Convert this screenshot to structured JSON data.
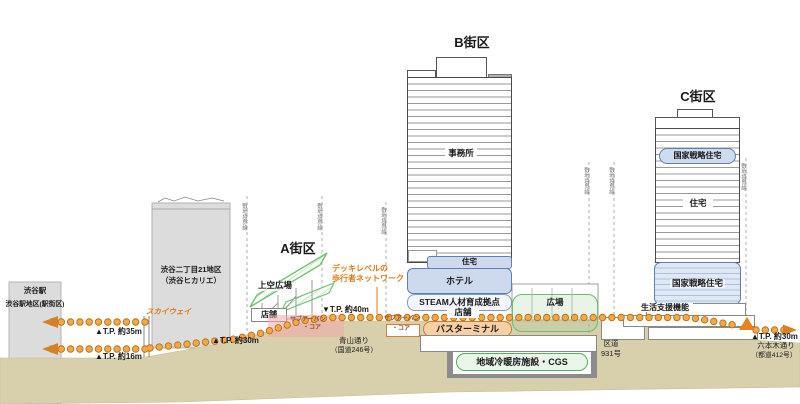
{
  "districts": {
    "a": {
      "label": "A街区",
      "sky_plaza": "上空広場",
      "shop": "店舗",
      "suburban_core_line1": "サブアーバン",
      "suburban_core_line2": "・コア"
    },
    "b": {
      "label": "B街区",
      "office": "事務所",
      "residence": "住宅",
      "hotel": "ホテル",
      "steam": "STEAM人材育成拠点",
      "shop": "店舗",
      "suburban_core_line1": "サブアーバン",
      "suburban_core_line2": "・コア",
      "bus_terminal": "バスターミナル",
      "plaza": "広場",
      "dhc": "地域冷暖房施設・CGS"
    },
    "c": {
      "label": "C街区",
      "nsh_upper": "国家戦略住宅",
      "residence": "住宅",
      "nsh_lower": "国家戦略住宅",
      "life_support": "生活支援機能"
    }
  },
  "left_area": {
    "station": "渋谷駅",
    "station_district": "渋谷駅地区(駅街区)",
    "hikarie_line1": "渋谷二丁目21地区",
    "hikarie_line2": "（渋谷ヒカリエ）",
    "skyway": "スカイウェイ"
  },
  "levels": {
    "tp35": "▲T.P. 約35m",
    "tp16": "▲T.P. 約16m",
    "tp30_a": "▲T.P. 約30m",
    "tp40_b": "▼T.P. 約40m",
    "tp30_c": "▲T.P. 約30m"
  },
  "deck_network": {
    "line1": "デッキレベルの",
    "line2": "歩行者ネットワーク"
  },
  "roads": {
    "aoyama_line1": "青山通り",
    "aoyama_line2": "（国道246号）",
    "ward_road_line1": "区道",
    "ward_road_line2": "931号",
    "roppongi_line1": "六本木通り",
    "roppongi_line2": "（都道412号）"
  },
  "boundary_line_label": "敷地境界線",
  "colors": {
    "deck_dot": "#f2a844",
    "deck_dot_edge": "#b87018",
    "orange_text": "#e07818",
    "green": "#5cb85c",
    "blue_border": "#5f7fae",
    "blue_fill": "#cdd9ec",
    "ground": "#d8cfad"
  }
}
